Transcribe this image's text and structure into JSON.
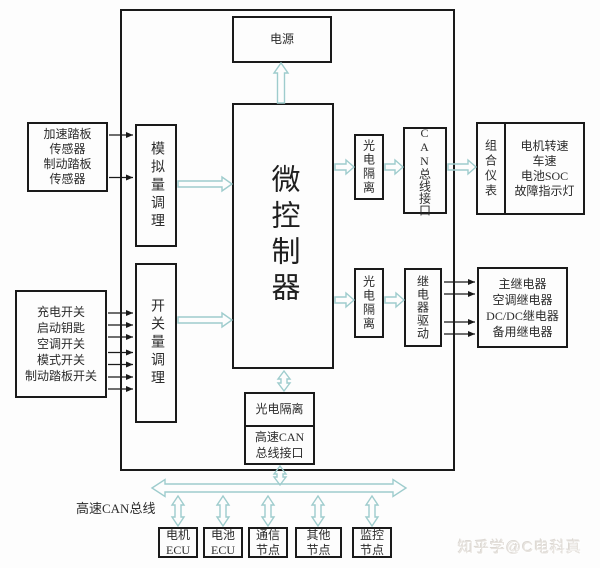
{
  "diagram": {
    "blocks": {
      "power": {
        "label": "电源"
      },
      "mcu": {
        "label": "微控制器"
      },
      "analog_cond": {
        "label": "模拟量调理"
      },
      "switch_cond": {
        "label": "开关量调理"
      },
      "pedal_sensors": {
        "lines": [
          "加速踏板",
          "传感器",
          "制动踏板",
          "传感器"
        ]
      },
      "switch_inputs": {
        "lines": [
          "充电开关",
          "启动钥匙",
          "空调开关",
          "模式开关",
          "制动踏板开关"
        ]
      },
      "opto_iso_top": {
        "label": "光电隔离"
      },
      "can_interface": {
        "label": "CAN总线接口"
      },
      "cluster": {
        "side_label": "组合仪表",
        "lines": [
          "电机转速",
          "车速",
          "电池SOC",
          "故障指示灯"
        ]
      },
      "opto_iso_mid": {
        "label": "光电隔离"
      },
      "relay_driver": {
        "label": "继电器驱动"
      },
      "relays": {
        "lines": [
          "主继电器",
          "空调继电器",
          "DC/DC继电器",
          "备用继电器"
        ]
      },
      "opto_iso_bottom": {
        "label": "光电隔离"
      },
      "hs_can_interface": {
        "lines": [
          "高速CAN",
          "总线接口"
        ]
      },
      "motor_ecu": {
        "lines": [
          "电机",
          "ECU"
        ]
      },
      "battery_ecu": {
        "lines": [
          "电池",
          "ECU"
        ]
      },
      "comm_node": {
        "lines": [
          "通信",
          "节点"
        ]
      },
      "other_node": {
        "lines": [
          "其他",
          "节点"
        ]
      },
      "monitor_node": {
        "lines": [
          "监控",
          "节点"
        ]
      }
    },
    "bus_label": "高速CAN总线",
    "watermark": "知乎学@C电科真",
    "colors": {
      "background": "#ffffff",
      "box_border": "#1a1a1a",
      "hollow_arrow": "#9ecccd",
      "thin_arrow": "#1a1a1a",
      "watermark": "#e6e2dd"
    }
  }
}
